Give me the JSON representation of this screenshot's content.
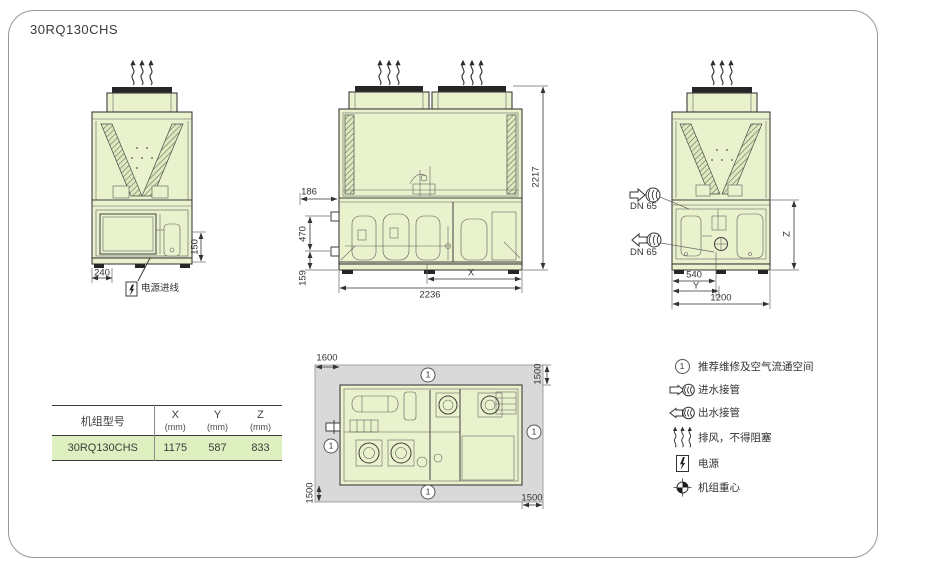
{
  "title": "30RQ130CHS",
  "front_view": {
    "dim_150": "150",
    "dim_240": "240",
    "power_inlet_label": "电源进线"
  },
  "side_view": {
    "dim_186": "186",
    "dim_470": "470",
    "dim_159": "159",
    "dim_2236": "2236",
    "dim_x": "X",
    "dim_2217": "2217"
  },
  "back_view": {
    "dn_inlet": "DN 65",
    "dn_outlet": "DN 65",
    "dim_540": "540",
    "dim_y": "Y",
    "dim_1200": "1200",
    "dim_z": "Z"
  },
  "plan_view": {
    "dim_left": "1600",
    "dim_top_right": "1500",
    "dim_bottom_left": "1500",
    "dim_bottom_right": "1500",
    "marker": "1"
  },
  "spec_table": {
    "header_model": "机组型号",
    "header_x": "X",
    "header_x_unit": "(mm)",
    "header_y": "Y",
    "header_y_unit": "(mm)",
    "header_z": "Z",
    "header_z_unit": "(mm)",
    "row_model": "30RQ130CHS",
    "row_x": "1175",
    "row_y": "587",
    "row_z": "833"
  },
  "legend": {
    "marker_char": "1",
    "items": [
      {
        "symbol": "circled-1",
        "label": "推荐维修及空气流通空间"
      },
      {
        "symbol": "water-inlet",
        "label": "进水接管"
      },
      {
        "symbol": "water-outlet",
        "label": "出水接管"
      },
      {
        "symbol": "exhaust",
        "label": "排风，不得阻塞"
      },
      {
        "symbol": "power",
        "label": "电源"
      },
      {
        "symbol": "gravity-center",
        "label": "机组重心"
      }
    ]
  },
  "colors": {
    "unit_fill": "#e9f2cd",
    "clearance_fill": "#d9d9d9",
    "line": "#3e3e3e",
    "table_row_fill": "#def0bf"
  }
}
